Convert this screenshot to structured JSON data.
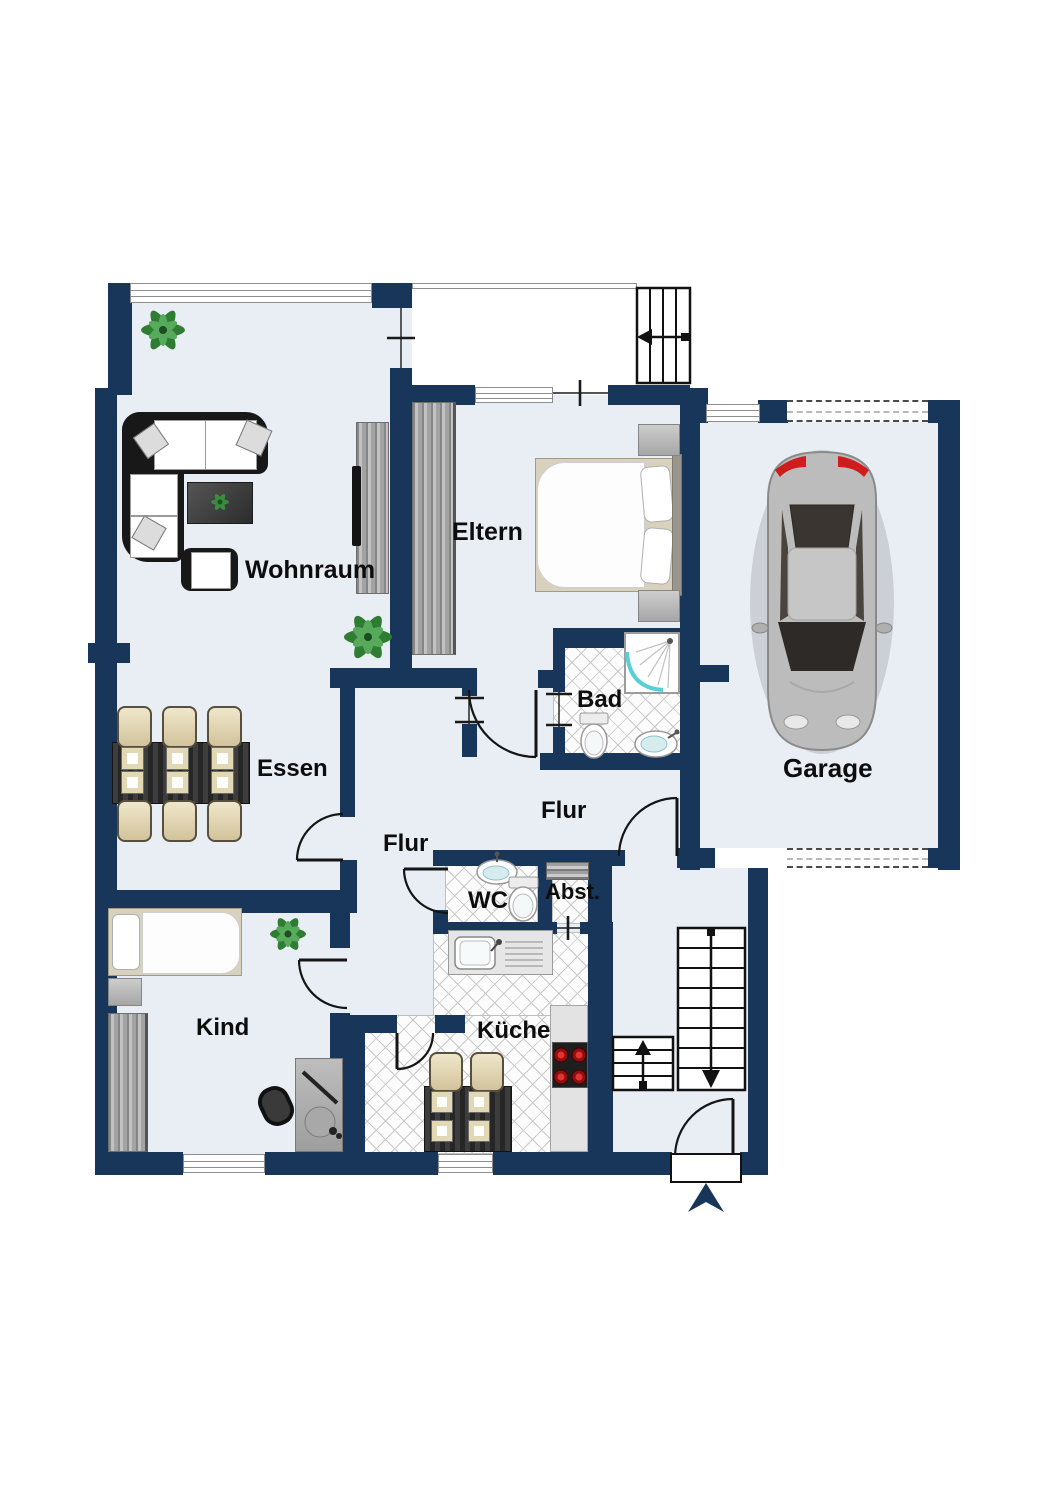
{
  "plan": {
    "type": "floorplan",
    "language": "de"
  },
  "colors": {
    "wall": "#18365a",
    "floor": "#e9edf4",
    "tile_bg": "#fcfcfc",
    "tile_line": "#c9c9c9",
    "door_line": "#151515",
    "entrance_arrow": "#18365a",
    "plant_green": "#2f7d33",
    "car_body": "#bcbcbc"
  },
  "rooms": {
    "wohnraum": {
      "label": "Wohnraum"
    },
    "eltern": {
      "label": "Eltern"
    },
    "garage": {
      "label": "Garage"
    },
    "bad": {
      "label": "Bad"
    },
    "flur_upper": {
      "label": "Flur"
    },
    "flur_lower": {
      "label": "Flur"
    },
    "essen": {
      "label": "Essen"
    },
    "kind": {
      "label": "Kind"
    },
    "wc": {
      "label": "WC"
    },
    "abstellraum": {
      "label": "Abst."
    },
    "kueche": {
      "label": "Küche"
    }
  }
}
